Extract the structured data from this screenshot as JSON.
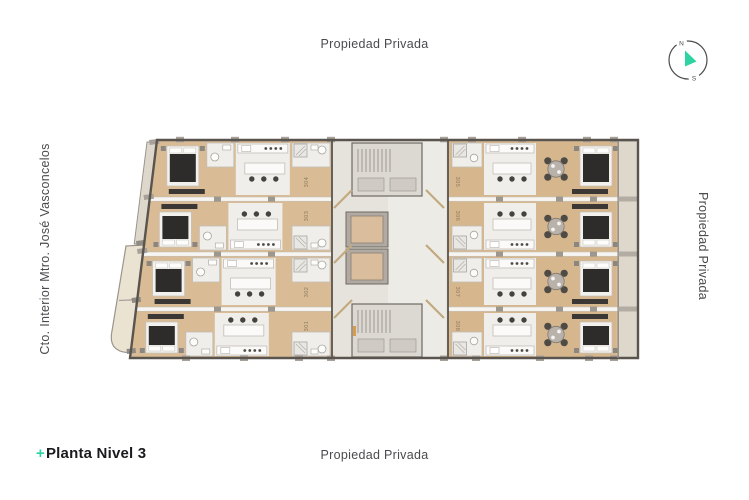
{
  "labels": {
    "top": "Propiedad Privada",
    "bottom": "Propiedad Privada",
    "right": "Propiedad Privada",
    "left": "Cto. Interior Mtro. José Vasconcelos"
  },
  "title": {
    "prefix": "+",
    "text": "Planta Nivel 3"
  },
  "compass": {
    "north": "N",
    "south": "S"
  },
  "plan": {
    "description": "Residential floor plan, level 3, eight apartment units around a central core with two elevators and two stair shafts",
    "units": [
      {
        "number": "304",
        "side": "left",
        "row": 1
      },
      {
        "number": "303",
        "side": "left",
        "row": 2
      },
      {
        "number": "302",
        "side": "left",
        "row": 3
      },
      {
        "number": "301",
        "side": "left",
        "row": 4
      },
      {
        "number": "305",
        "side": "right",
        "row": 1
      },
      {
        "number": "306",
        "side": "right",
        "row": 2
      },
      {
        "number": "307",
        "side": "right",
        "row": 3
      },
      {
        "number": "308",
        "side": "right",
        "row": 4
      }
    ],
    "colors": {
      "accent": "#2ed3a4",
      "wall": "#5a544e",
      "wood": "#d9bc95",
      "wood_right": "#d6b68c",
      "white_floor": "#f0eeea",
      "core": "#e6e3dd",
      "corridor": "#edebe6",
      "stair": "#dcd8d2",
      "terrace": "#ebe3d2",
      "balcony": "#ded8cc",
      "duvet": "#2e2c2a",
      "elevator": "#d9bd9c",
      "dark_furniture": "#3a3734"
    }
  }
}
